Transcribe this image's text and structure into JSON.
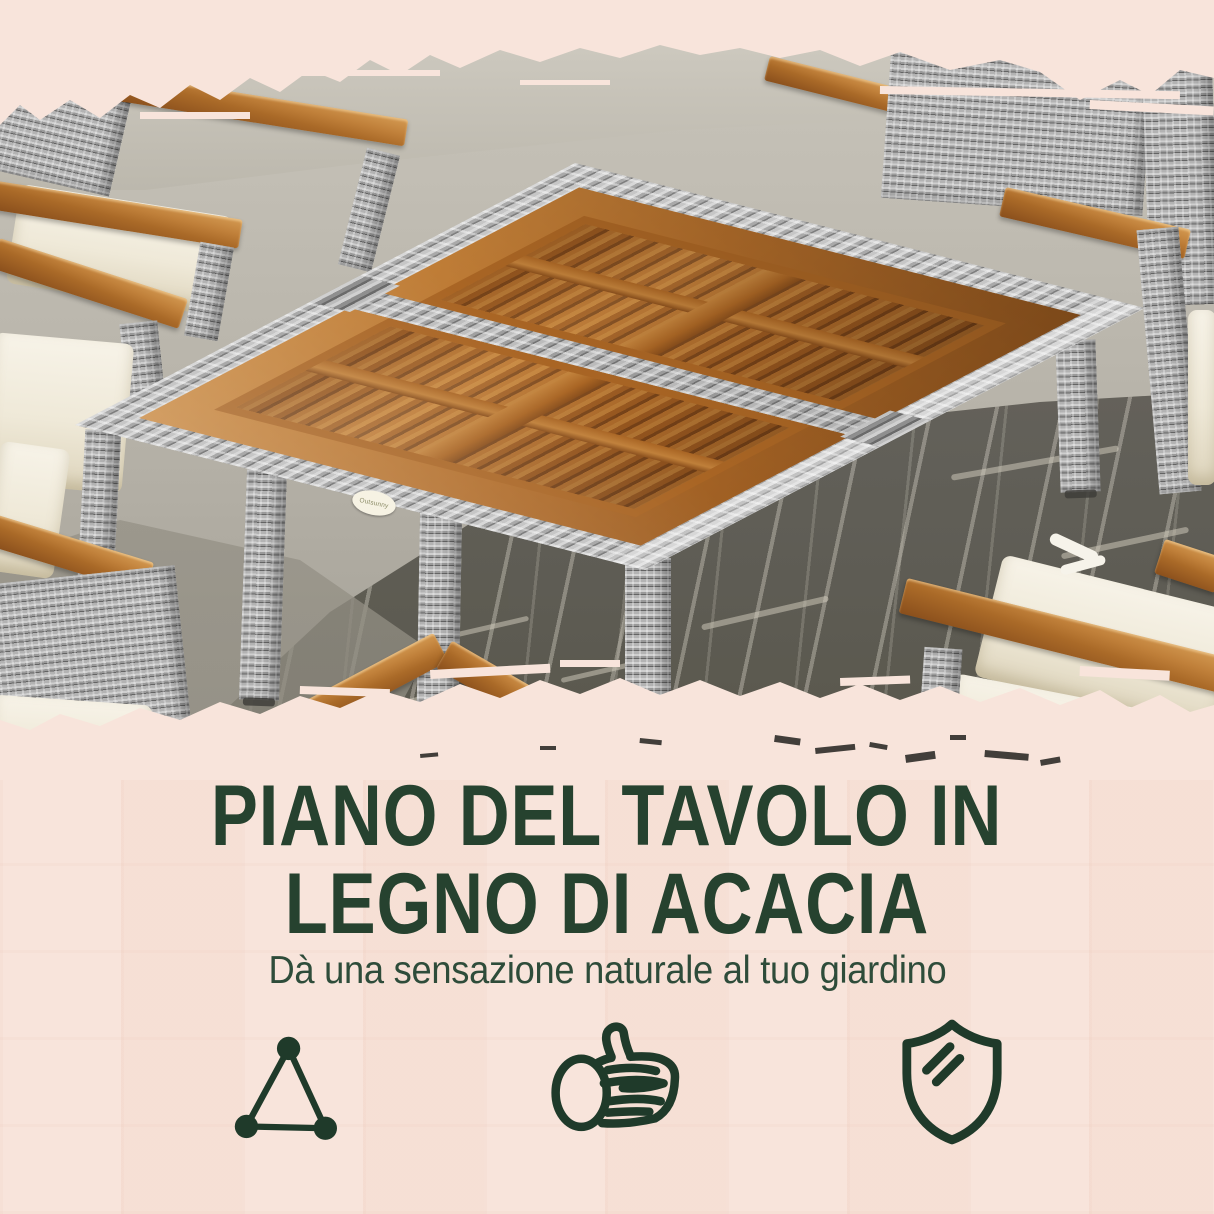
{
  "brand": {
    "badge_label": "Outsunny"
  },
  "headline": {
    "line1": "PIANO DEL TAVOLO IN",
    "line2": "LEGNO DI ACACIA"
  },
  "subheadline": "Dà una sensazione naturale al tuo giardino",
  "features": [
    {
      "icon": "triangle-structure-icon"
    },
    {
      "icon": "wood-log-icon"
    },
    {
      "icon": "shield-protection-icon"
    }
  ],
  "colors": {
    "background_pink": "#f8e4db",
    "headline_green": "#26422f",
    "subheadline_green": "#2e4c3a",
    "icon_green": "#1f3a2a",
    "wood_brown": "#b5722f",
    "wicker_gray": "#9c9c9c",
    "cushion_cream": "#f3eee1",
    "concrete_gray": "#bdb9af",
    "shadow_gray": "#5d5b54"
  }
}
